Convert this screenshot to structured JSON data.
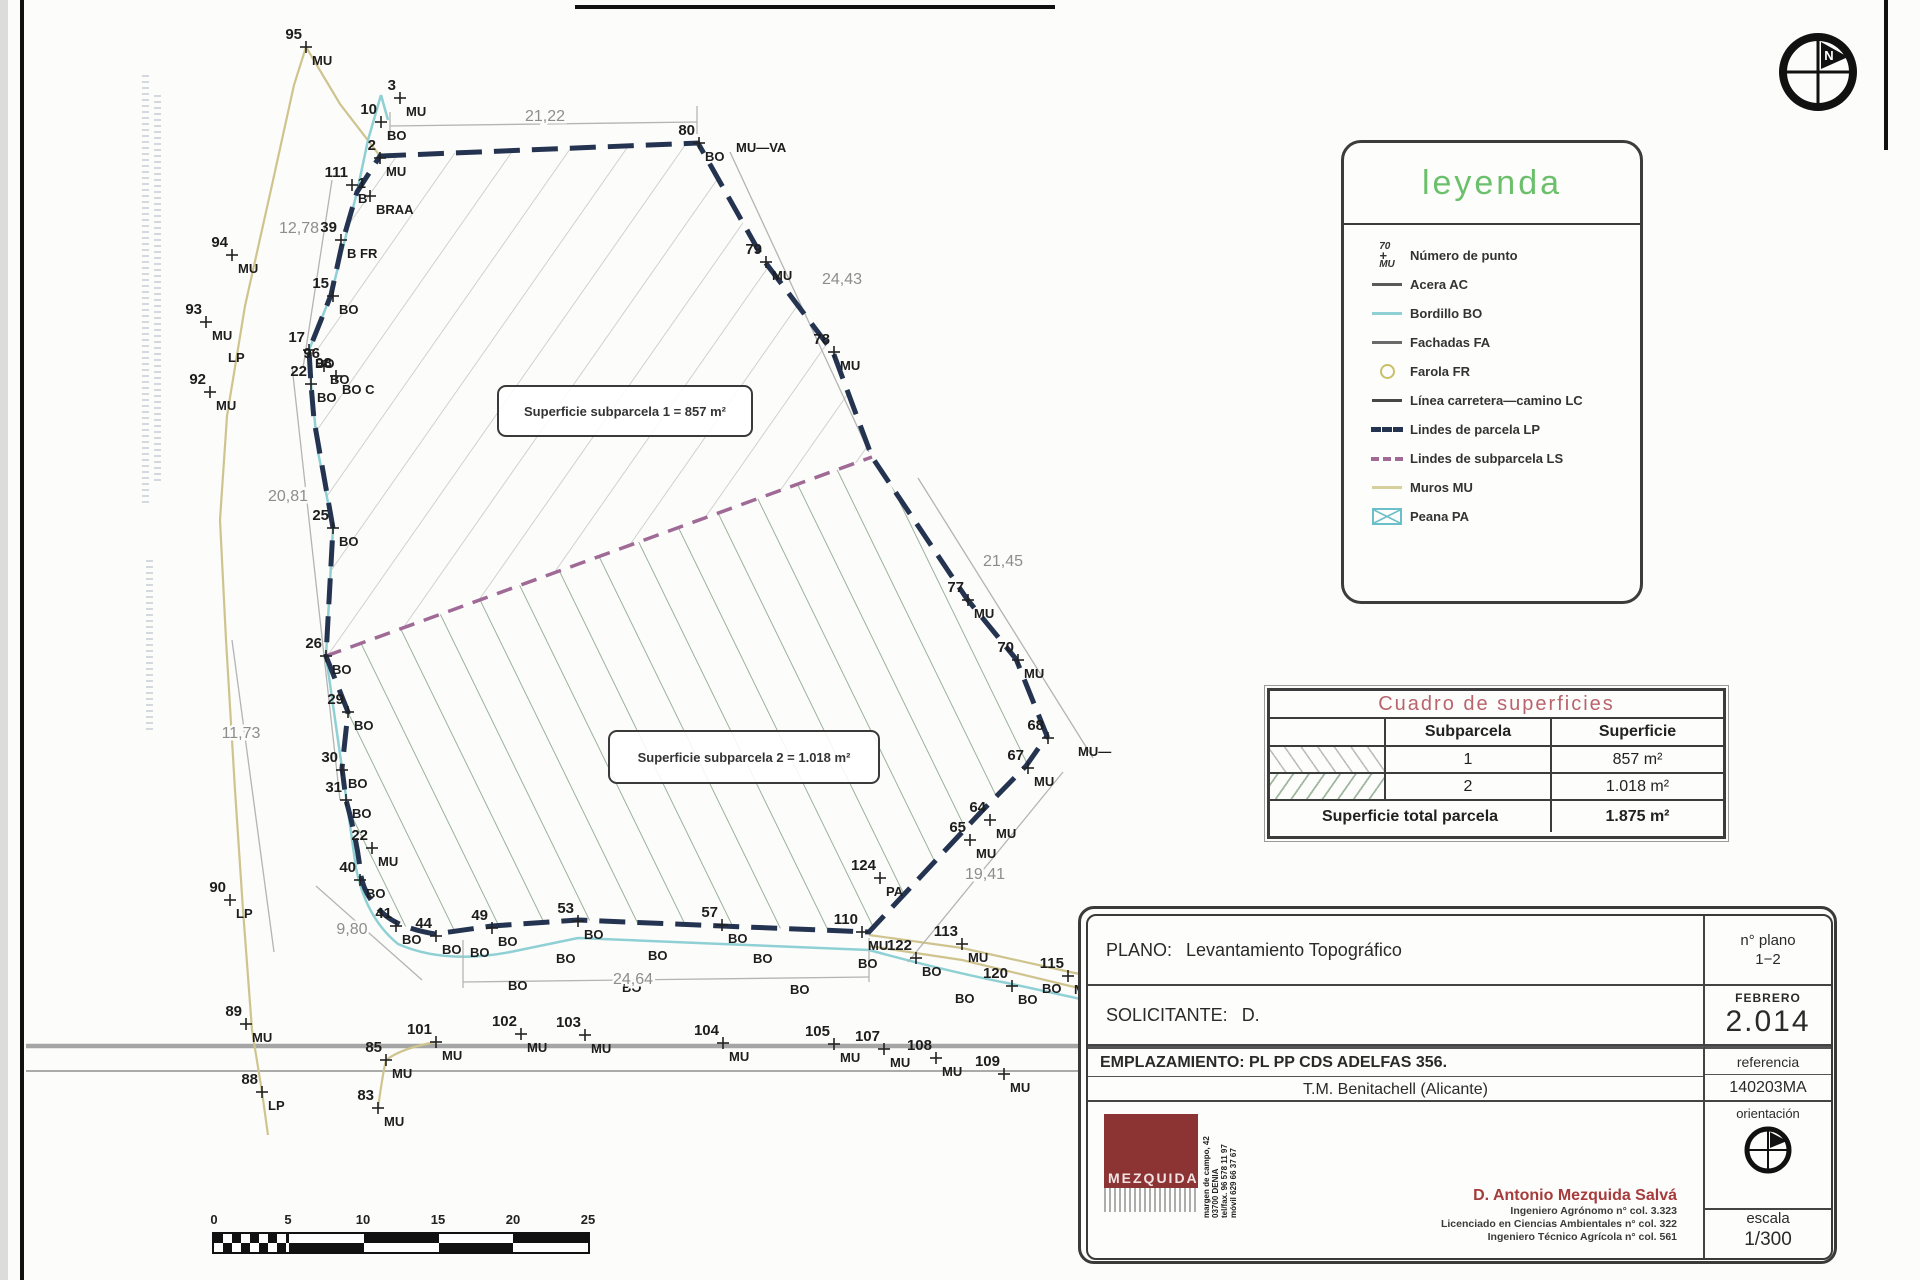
{
  "colors": {
    "parcel_boundary_navy": "#243350",
    "bordillo_cyan": "#8fd0d4",
    "muros_tan": "#d6cf9e",
    "subparcel_line_purple": "#a06a96",
    "hatch_gray": "#bdbdbd",
    "hatch_green": "#9fb89f",
    "legend_title_green": "#6cc06c",
    "table_title_rose": "#b9646c",
    "logo_maroon": "#8c3434",
    "engineer_name_red": "#a63b3b"
  },
  "legend": {
    "title": "leyenda",
    "items": [
      {
        "num": "70",
        "code": "MU",
        "label": "Número de punto"
      },
      {
        "label": "Acera AC"
      },
      {
        "label": "Bordillo BO"
      },
      {
        "label": "Fachadas FA"
      },
      {
        "label": "Farola FR"
      },
      {
        "label": "Línea carretera—camino LC"
      },
      {
        "label": "Lindes de parcela LP"
      },
      {
        "label": "Lindes de subparcela LS"
      },
      {
        "label": "Muros MU"
      },
      {
        "label": "Peana PA"
      }
    ]
  },
  "surfaces_table": {
    "title": "Cuadro de superficies",
    "col_subparcela": "Subparcela",
    "col_superficie": "Superficie",
    "rows": [
      {
        "subparcela": "1",
        "superficie": "857 m²"
      },
      {
        "subparcela": "2",
        "superficie": "1.018 m²"
      }
    ],
    "total_label": "Superficie total parcela",
    "total_value": "1.875 m²"
  },
  "title_block": {
    "plano_label": "PLANO:",
    "plano_value": "Levantamiento Topográfico",
    "n_plano_label": "n° plano",
    "n_plano_value": "1−2",
    "solicitante_label": "SOLICITANTE:",
    "solicitante_value": "D.",
    "fecha_mes": "FEBRERO",
    "fecha_anio": "2.014",
    "emplazamiento_line1": "EMPLAZAMIENTO:  PL PP CDS ADELFAS 356.",
    "emplazamiento_line2": "T.M. Benitachell (Alicante)",
    "referencia_label": "referencia",
    "referencia_value": "140203MA",
    "orientacion_label": "orientación",
    "escala_label": "escala",
    "escala_value": "1/300",
    "engineer_name": "D. Antonio Mezquida Salvá",
    "engineer_lines": [
      "Ingeniero Agrónomo n° col. 3.323",
      "Licenciado en Ciencias Ambientales n° col. 322",
      "Ingeniero Técnico Agrícola n° col. 561"
    ],
    "logo_text": "MEZQUIDA",
    "logo_side_lines": [
      "margen de campo, 42",
      "03700 DENIA",
      "tel/fax. 96 578 11 97",
      "móvil 629 66 37 67"
    ]
  },
  "drawing": {
    "subparcel1_label": "Superficie subparcela 1 = 857 m²",
    "subparcel2_label": "Superficie subparcela 2 = 1.018 m²",
    "points": [
      {
        "n": "95",
        "c": "MU",
        "x": 306,
        "y": 47
      },
      {
        "n": "3",
        "c": "MU",
        "x": 400,
        "y": 98
      },
      {
        "n": "10",
        "c": "BO",
        "x": 381,
        "y": 122
      },
      {
        "n": "2",
        "c": "MU",
        "x": 380,
        "y": 158
      },
      {
        "n": "111",
        "c": "B",
        "x": 352,
        "y": 185
      },
      {
        "n": "1",
        "c": "BRAA",
        "x": 370,
        "y": 196
      },
      {
        "n": "139",
        "c": "B FR",
        "x": 341,
        "y": 240
      },
      {
        "n": "15",
        "c": "BO",
        "x": 333,
        "y": 296
      },
      {
        "n": "17",
        "c": "BO",
        "x": 309,
        "y": 350
      },
      {
        "n": "22",
        "c": "BO",
        "x": 311,
        "y": 384
      },
      {
        "n": "96",
        "c": "BO",
        "x": 324,
        "y": 366
      },
      {
        "n": "98",
        "c": "BO C",
        "x": 336,
        "y": 376
      },
      {
        "n": "25",
        "c": "BO",
        "x": 333,
        "y": 528
      },
      {
        "n": "26",
        "c": "BO",
        "x": 326,
        "y": 656
      },
      {
        "n": "29",
        "c": "BO",
        "x": 348,
        "y": 712
      },
      {
        "n": "30",
        "c": "BO",
        "x": 342,
        "y": 770
      },
      {
        "n": "31",
        "c": "BO",
        "x": 346,
        "y": 800
      },
      {
        "n": "22",
        "c": "MU",
        "x": 372,
        "y": 848
      },
      {
        "n": "40",
        "c": "BO",
        "x": 360,
        "y": 880
      },
      {
        "n": "41",
        "c": "BO",
        "x": 396,
        "y": 926
      },
      {
        "n": "44",
        "c": "BO",
        "x": 436,
        "y": 936
      },
      {
        "n": "49",
        "c": "BO",
        "x": 492,
        "y": 928
      },
      {
        "n": "53",
        "c": "BO",
        "x": 578,
        "y": 921
      },
      {
        "n": "57",
        "c": "BO",
        "x": 722,
        "y": 925
      },
      {
        "n": "110",
        "c": "MU",
        "x": 862,
        "y": 932
      },
      {
        "n": "122",
        "c": "BO",
        "x": 916,
        "y": 958
      },
      {
        "n": "113",
        "c": "MU",
        "x": 962,
        "y": 944
      },
      {
        "n": "120",
        "c": "BO",
        "x": 1012,
        "y": 986
      },
      {
        "n": "115",
        "c": "MU",
        "x": 1068,
        "y": 976
      },
      {
        "n": "124",
        "c": "PA",
        "x": 880,
        "y": 878
      },
      {
        "n": "64",
        "c": "MU",
        "x": 990,
        "y": 820
      },
      {
        "n": "65",
        "c": "MU",
        "x": 970,
        "y": 840
      },
      {
        "n": "67",
        "c": "MU",
        "x": 1028,
        "y": 768
      },
      {
        "n": "68",
        "c": "",
        "x": 1048,
        "y": 738
      },
      {
        "n": "70",
        "c": "MU",
        "x": 1018,
        "y": 660
      },
      {
        "n": "77",
        "c": "MU",
        "x": 968,
        "y": 600
      },
      {
        "n": "78",
        "c": "MU",
        "x": 834,
        "y": 352
      },
      {
        "n": "79",
        "c": "MU",
        "x": 766,
        "y": 262
      },
      {
        "n": "80",
        "c": "BO",
        "x": 699,
        "y": 143
      },
      {
        "n": "94",
        "c": "MU",
        "x": 232,
        "y": 255
      },
      {
        "n": "93",
        "c": "MU",
        "x": 206,
        "y": 322
      },
      {
        "n": "92",
        "c": "MU",
        "x": 210,
        "y": 392
      },
      {
        "n": "90",
        "c": "LP",
        "x": 230,
        "y": 900
      },
      {
        "n": "89",
        "c": "MU",
        "x": 246,
        "y": 1024
      },
      {
        "n": "88",
        "c": "LP",
        "x": 262,
        "y": 1092
      },
      {
        "n": "85",
        "c": "MU",
        "x": 386,
        "y": 1060
      },
      {
        "n": "83",
        "c": "MU",
        "x": 378,
        "y": 1108
      },
      {
        "n": "101",
        "c": "MU",
        "x": 436,
        "y": 1042
      },
      {
        "n": "102",
        "c": "MU",
        "x": 521,
        "y": 1034
      },
      {
        "n": "103",
        "c": "MU",
        "x": 585,
        "y": 1035
      },
      {
        "n": "104",
        "c": "MU",
        "x": 723,
        "y": 1043
      },
      {
        "n": "105",
        "c": "MU",
        "x": 834,
        "y": 1044
      },
      {
        "n": "107",
        "c": "MU",
        "x": 884,
        "y": 1049
      },
      {
        "n": "108",
        "c": "MU",
        "x": 936,
        "y": 1058
      },
      {
        "n": "109",
        "c": "MU",
        "x": 1004,
        "y": 1074
      }
    ],
    "annotations": [
      {
        "t": "MU—VA",
        "x": 736,
        "y": 152
      },
      {
        "t": "MU—",
        "x": 1078,
        "y": 756
      },
      {
        "t": "LP",
        "x": 228,
        "y": 362
      },
      {
        "t": "BO",
        "x": 470,
        "y": 957
      },
      {
        "t": "BO",
        "x": 556,
        "y": 963
      },
      {
        "t": "BO",
        "x": 648,
        "y": 960
      },
      {
        "t": "BO",
        "x": 753,
        "y": 963
      },
      {
        "t": "BO",
        "x": 858,
        "y": 968
      },
      {
        "t": "BO",
        "x": 508,
        "y": 990
      },
      {
        "t": "BO",
        "x": 622,
        "y": 992
      },
      {
        "t": "BO",
        "x": 790,
        "y": 994
      },
      {
        "t": "BO",
        "x": 955,
        "y": 1003
      },
      {
        "t": "BO",
        "x": 1042,
        "y": 993
      }
    ],
    "dimensions": [
      {
        "t": "21,22",
        "x": 545,
        "y": 121
      },
      {
        "t": "12,78",
        "x": 299,
        "y": 233
      },
      {
        "t": "24,43",
        "x": 842,
        "y": 284
      },
      {
        "t": "21,45",
        "x": 1003,
        "y": 566
      },
      {
        "t": "19,41",
        "x": 985,
        "y": 879
      },
      {
        "t": "24,64",
        "x": 633,
        "y": 984
      },
      {
        "t": "9,80",
        "x": 352,
        "y": 934
      },
      {
        "t": "11,73",
        "x": 241,
        "y": 738
      },
      {
        "t": "20,81",
        "x": 288,
        "y": 501
      }
    ]
  },
  "scale_bar": {
    "labels": [
      "0",
      "5",
      "10",
      "15",
      "20",
      "25"
    ]
  },
  "north_symbol_letter": "N"
}
